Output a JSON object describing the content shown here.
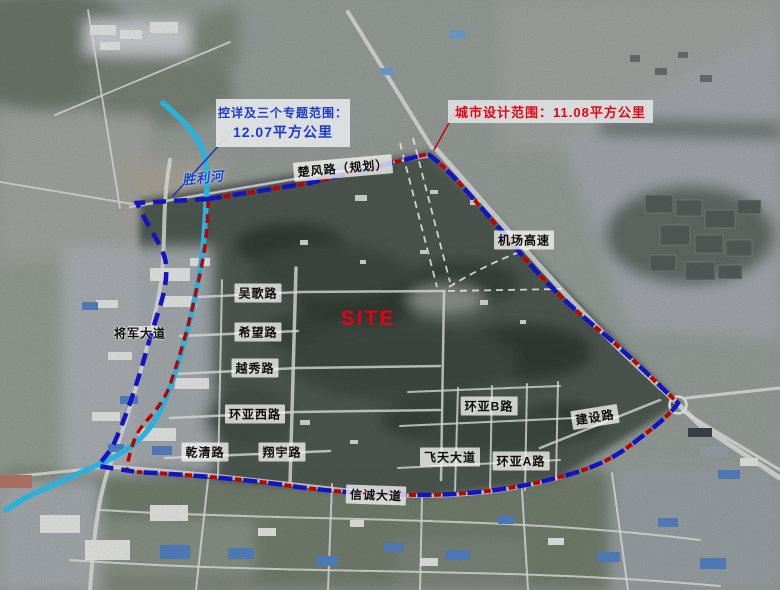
{
  "callouts": {
    "control_scope": {
      "line1": "控详及三个专题范围：",
      "line2": "12.07平方公里"
    },
    "design_scope": {
      "text": "城市设计范围：11.08平方公里"
    }
  },
  "site_label": "SITE",
  "river_label": "胜利河",
  "road_labels": [
    {
      "id": "chufeng",
      "text": "楚风路（规划）"
    },
    {
      "id": "jichang",
      "text": "机场高速"
    },
    {
      "id": "wuge",
      "text": "吴歌路"
    },
    {
      "id": "xiwang",
      "text": "希望路"
    },
    {
      "id": "yuexiu",
      "text": "越秀路"
    },
    {
      "id": "huanya_xi",
      "text": "环亚西路"
    },
    {
      "id": "qianqing",
      "text": "乾清路"
    },
    {
      "id": "xiangyu",
      "text": "翔宇路"
    },
    {
      "id": "jiangjun",
      "text": "将军大道"
    },
    {
      "id": "xincheng",
      "text": "信诚大道"
    },
    {
      "id": "feitian",
      "text": "飞天大道"
    },
    {
      "id": "huanya_a",
      "text": "环亚A路"
    },
    {
      "id": "huanya_b",
      "text": "环亚B路"
    },
    {
      "id": "jianshe",
      "text": "建设路"
    }
  ],
  "colors": {
    "boundary_blue": "#1616d4",
    "boundary_red": "#d40000",
    "river_cyan": "#2fc4f0",
    "site_red": "#e60012",
    "callout_blue_text": "#1c3bc8",
    "callout_red_text": "#e30613"
  }
}
